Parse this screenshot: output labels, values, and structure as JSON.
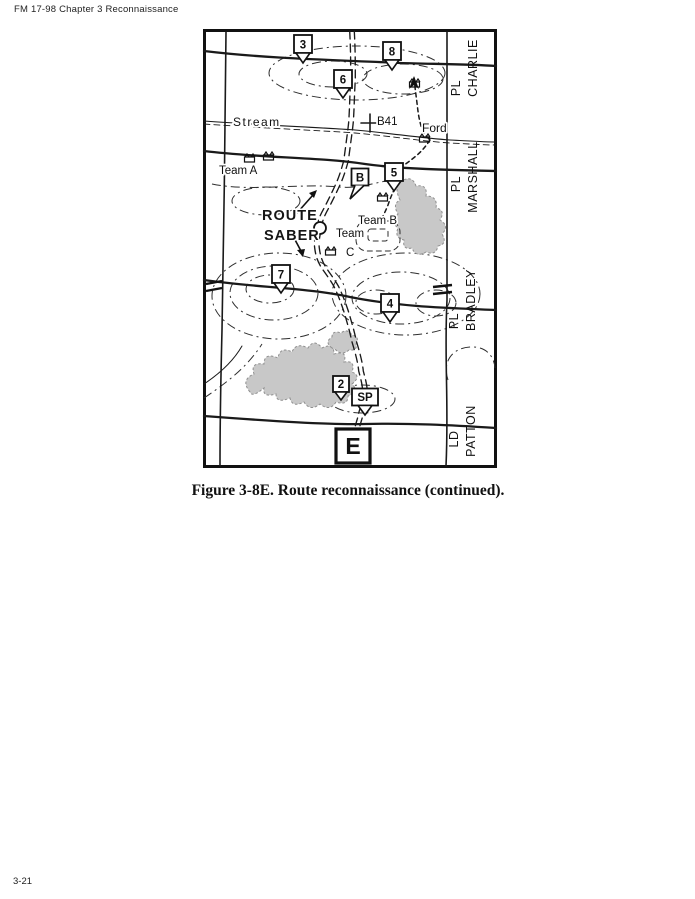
{
  "page": {
    "header": "FM 17-98 Chapter 3 Reconnaissance",
    "caption": "Figure 3-8E. Route reconnaissance (continued).",
    "page_number": "3-21"
  },
  "map": {
    "route_title": {
      "line1": "ROUTE",
      "line2": "SABER"
    },
    "checkpoints": [
      "3",
      "8",
      "6",
      "5",
      "7",
      "4",
      "2"
    ],
    "start_point": "SP",
    "bridge_marker": "B",
    "bridge_name": "B41",
    "exit_marker": "E",
    "stream_label": "Stream",
    "ford_label": "Ford",
    "teams": {
      "a": "Team A",
      "b": "Team B",
      "c_line1": "Team",
      "c_line2": "C"
    },
    "phase_lines": [
      {
        "prefix": "PL",
        "name": "CHARLIE"
      },
      {
        "prefix": "PL",
        "name": "MARSHALL"
      },
      {
        "prefix": "PL",
        "name": "BRADLEY"
      },
      {
        "prefix": "LD",
        "name": "PATTON"
      }
    ],
    "colors": {
      "ink": "#1a1a1a",
      "woods": "#c8c8c8"
    }
  }
}
